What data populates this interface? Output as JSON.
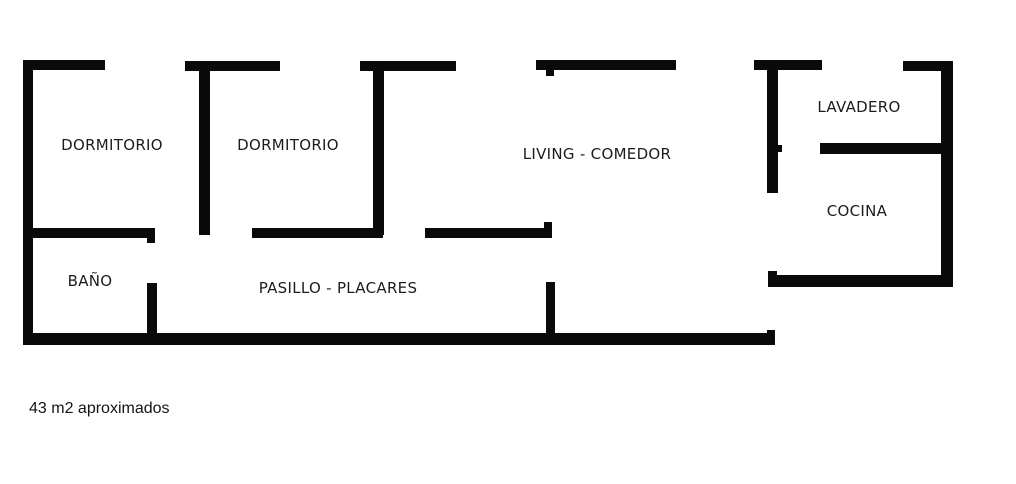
{
  "palette": {
    "background": "#ffffff",
    "wall_color": "#0a0a0a",
    "text_color": "#1c1c1c"
  },
  "floor_plan": {
    "caption": "43 m2 aproximados",
    "rooms": [
      {
        "name": "dormitorio-1",
        "label": "DORMITORIO",
        "cx": 112,
        "cy": 145
      },
      {
        "name": "dormitorio-2",
        "label": "DORMITORIO",
        "cx": 288,
        "cy": 145
      },
      {
        "name": "living-comedor",
        "label": "LIVING - COMEDOR",
        "cx": 597,
        "cy": 154
      },
      {
        "name": "lavadero",
        "label": "LAVADERO",
        "cx": 859,
        "cy": 107
      },
      {
        "name": "cocina",
        "label": "COCINA",
        "cx": 857,
        "cy": 211
      },
      {
        "name": "bano",
        "label": "BAÑO",
        "cx": 90,
        "cy": 281
      },
      {
        "name": "pasillo-placares",
        "label": "PASILLO - PLACARES",
        "cx": 338,
        "cy": 288
      }
    ],
    "walls": [
      {
        "name": "wall-outer-left",
        "x": 23,
        "y": 60,
        "w": 10,
        "h": 285
      },
      {
        "name": "wall-outer-bottom",
        "x": 23,
        "y": 333,
        "w": 752,
        "h": 12
      },
      {
        "name": "wall-outer-right",
        "x": 941,
        "y": 61,
        "w": 12,
        "h": 226
      },
      {
        "name": "wall-top-segment-1",
        "x": 23,
        "y": 60,
        "w": 82,
        "h": 10
      },
      {
        "name": "wall-top-segment-2",
        "x": 185,
        "y": 61,
        "w": 95,
        "h": 10
      },
      {
        "name": "wall-top-segment-3",
        "x": 360,
        "y": 61,
        "w": 96,
        "h": 10
      },
      {
        "name": "wall-top-segment-4",
        "x": 536,
        "y": 60,
        "w": 140,
        "h": 10
      },
      {
        "name": "wall-top-segment-5",
        "x": 754,
        "y": 60,
        "w": 68,
        "h": 10
      },
      {
        "name": "wall-top-segment-6",
        "x": 903,
        "y": 61,
        "w": 50,
        "h": 10
      },
      {
        "name": "wall-divider-dorm1-dorm2",
        "x": 199,
        "y": 66,
        "w": 11,
        "h": 169
      },
      {
        "name": "wall-divider-dorm2-living",
        "x": 373,
        "y": 66,
        "w": 11,
        "h": 169
      },
      {
        "name": "wall-divider-living-lavadero",
        "x": 767,
        "y": 66,
        "w": 11,
        "h": 127
      },
      {
        "name": "wall-divider-lavadero-cocina",
        "x": 820,
        "y": 143,
        "w": 133,
        "h": 11
      },
      {
        "name": "wall-cocina-bottom",
        "x": 768,
        "y": 275,
        "w": 185,
        "h": 12
      },
      {
        "name": "wall-bano-top",
        "x": 27,
        "y": 228,
        "w": 128,
        "h": 10
      },
      {
        "name": "wall-pasillo-top-left",
        "x": 252,
        "y": 228,
        "w": 131,
        "h": 10
      },
      {
        "name": "wall-pasillo-top-right",
        "x": 425,
        "y": 228,
        "w": 127,
        "h": 10
      },
      {
        "name": "wall-placard-divider-1",
        "x": 147,
        "y": 283,
        "w": 10,
        "h": 56
      },
      {
        "name": "wall-placard-divider-2",
        "x": 546,
        "y": 282,
        "w": 9,
        "h": 57
      },
      {
        "name": "tick-living-door-jamb",
        "x": 546,
        "y": 70,
        "w": 8,
        "h": 6
      },
      {
        "name": "tick-lavadero-door-jamb",
        "x": 778,
        "y": 145,
        "w": 4,
        "h": 7
      },
      {
        "name": "tick-bano-door-jamb",
        "x": 147,
        "y": 238,
        "w": 8,
        "h": 5
      },
      {
        "name": "tick-pasillo-door-jamb",
        "x": 544,
        "y": 222,
        "w": 8,
        "h": 6
      },
      {
        "name": "tick-cocina-wall-end",
        "x": 768,
        "y": 271,
        "w": 9,
        "h": 5
      },
      {
        "name": "tick-bottom-wall-end",
        "x": 767,
        "y": 330,
        "w": 8,
        "h": 4
      }
    ]
  }
}
